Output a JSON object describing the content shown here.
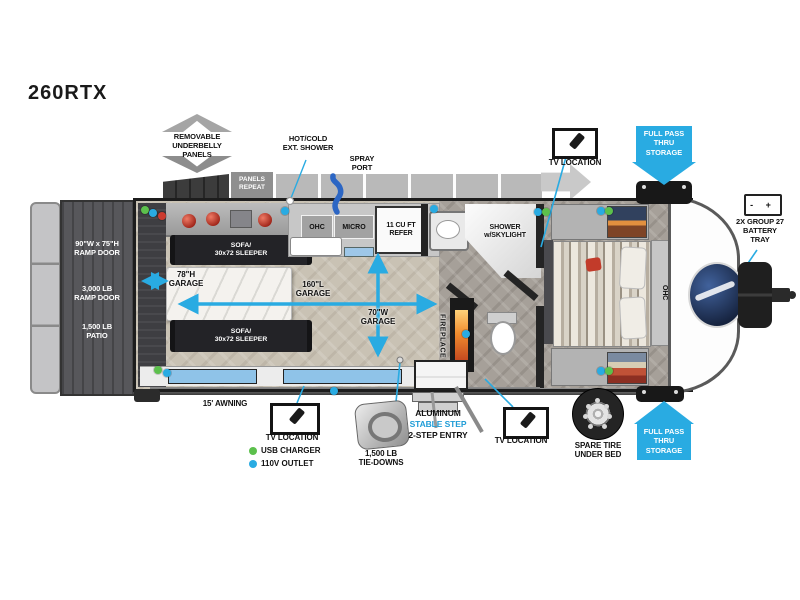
{
  "title": "260RTX",
  "colors": {
    "accent_blue": "#29ABE2",
    "usb_green": "#5CC04C",
    "outlet_blue": "#29ABE2",
    "ramp_gray": "#57575B"
  },
  "exterior": {
    "underbelly": "REMOVABLE\nUNDERBELLY\nPANELS",
    "panels_repeat": "PANELS\nREPEAT",
    "ext_shower": "HOT/COLD\nEXT. SHOWER",
    "spray_port": "SPRAY\nPORT",
    "tv_location": "TV LOCATION",
    "full_pass_thru": "FULL PASS\nTHRU\nSTORAGE",
    "battery": "2X GROUP 27\nBATTERY\nTRAY",
    "battery_icon": "- +",
    "spare_tire": "SPARE TIRE\nUNDER BED",
    "awning": "15' AWNING",
    "step1": "ALUMINUM",
    "step2": "STABLE STEP",
    "step3": "2-STEP ENTRY",
    "tie_downs": "1,500 LB\nTIE-DOWNS"
  },
  "ramp": {
    "size": "90\"W x 75\"H\nRAMP DOOR",
    "capacity": "3,000 LB\nRAMP DOOR",
    "patio": "1,500 LB\nPATIO"
  },
  "interior": {
    "sofa": "SOFA/\n30x72 SLEEPER",
    "garage_length": "160\"L\nGARAGE",
    "garage_width": "70\"W\nGARAGE",
    "garage_height": "78\"H\nGARAGE",
    "ohc": "OHC",
    "micro": "MICRO",
    "refer": "11 CU FT\nREFER",
    "shower": "SHOWER\nw/SKYLIGHT",
    "fireplace": "FIREPLACE",
    "bed_ohc": "OHC"
  },
  "legend": {
    "usb": "USB CHARGER",
    "outlet": "110V OUTLET"
  }
}
